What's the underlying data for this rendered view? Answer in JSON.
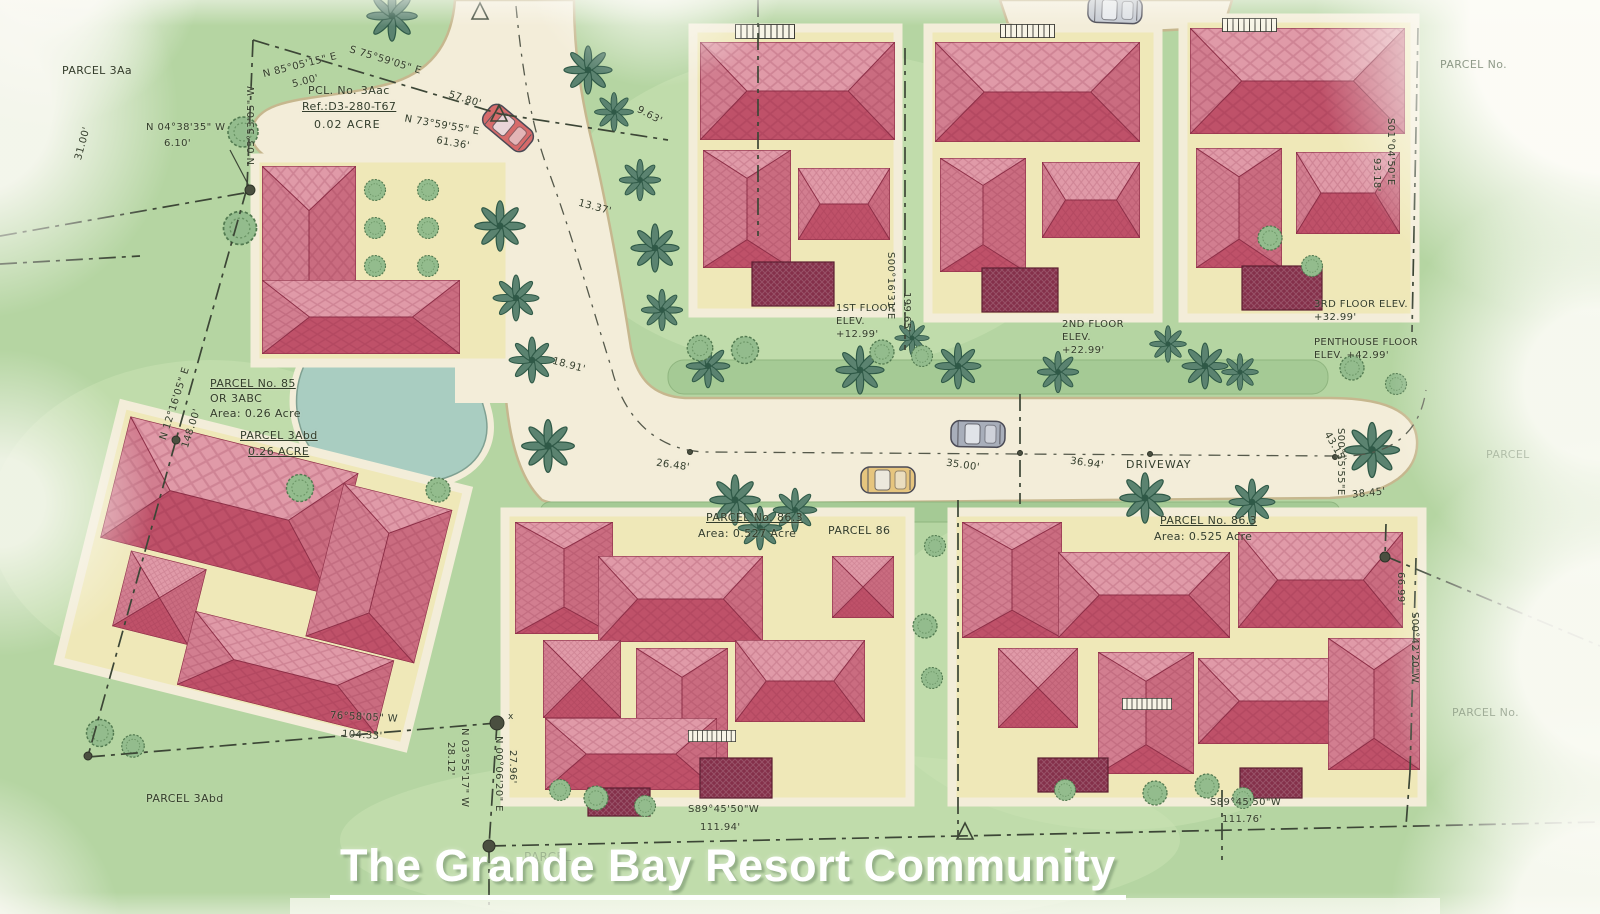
{
  "title": "The Grande Bay Resort Community",
  "colors": {
    "grass": "#b5d5a2",
    "road": "#f3edd9",
    "roof_red": "#c25a70",
    "roof_dark": "#84304a",
    "pond": "#a9cdc1",
    "tree_green": "#5b8370",
    "title_white": "#ffffff",
    "ink": "#333d2b"
  },
  "labels": {
    "parcel_3aa": "PARCEL 3Aa",
    "b_n035305w": "N 03°53'05\" W",
    "d_3100": "31.00'",
    "b_n850515e": "N 85°05'15\" E",
    "d_500": "5.00'",
    "b_s755905e": "S 75°59'05\" E",
    "pcl_3aac_1": "PCL. No. 3Aac",
    "pcl_3aac_2": "Ref.:D3-280-T67",
    "d_5780": "57.80'",
    "pcl_3aac_3": "0.02 ACRE",
    "b_n735955e": "N 73°59'55\" E",
    "d_6136": "61.36'",
    "b_n043835w": "N 04°38'35\" W",
    "d_610": "6.10'",
    "d_963": "9.63'",
    "d_1337": "13.37'",
    "d_1891": "18.91'",
    "b_n121605e": "N 12°16'05\" E",
    "d_14800": "148.00'",
    "p85_1": "PARCEL No. 85",
    "p85_2": "OR 3ABC",
    "p85_3": "Area: 0.26 Acre",
    "p3abd_1": "PARCEL 3Abd",
    "p3abd_2": "0.26 ACRE",
    "fl1": "1ST FLOOR ELEV. +12.99'",
    "b_s001631e": "S00°16'31\"E",
    "d_19965": "199.65'",
    "fl2": "2ND FLOOR ELEV. +22.99'",
    "fl3": "3RD FLOOR ELEV. +32.99'",
    "fl4": "PENTHOUSE FLOOR ELEV. +42.99'",
    "parcel_no_tr": "PARCEL No.",
    "b_s010450e": "S01°04'50\"E",
    "d_9318": "93.18'",
    "p863a_1": "PARCEL No. 86.3",
    "p863a_2": "Area: 0.527 Acre",
    "parcel_86": "PARCEL 86",
    "driveway": "DRIVEWAY",
    "p863b_1": "PARCEL No. 86.3",
    "p863b_2": "Area: 0.525 Acre",
    "d_2648": "26.48'",
    "d_3500": "35.00'",
    "d_3694": "36.94'",
    "d_3845": "38.45'",
    "b_s001555e": "S00°15'55\"E",
    "d_4315": "43.15'",
    "parcel_r1": "PARCEL",
    "b_s004220w": "S00°42'20\"W",
    "d_6699": "66.99'",
    "parcel_r2": "PARCEL No.",
    "b_765805w": "76°58'05\" W",
    "d_10433": "104.33'",
    "b_n035517w": "N 03°55'17\" W",
    "d_2812": "28.12'",
    "b_n000620e": "N 00°06'20\" E",
    "d_2796": "27.96'",
    "b_s894550w_a": "S89°45'50\"W",
    "d_11194": "111.94'",
    "b_s894550w_b": "S89°45'50\"W",
    "d_11176": "111.76'",
    "parcel_3abd_b": "PARCEL 3Abd",
    "faded_mid": "PARCEL",
    "d_x": "x"
  }
}
